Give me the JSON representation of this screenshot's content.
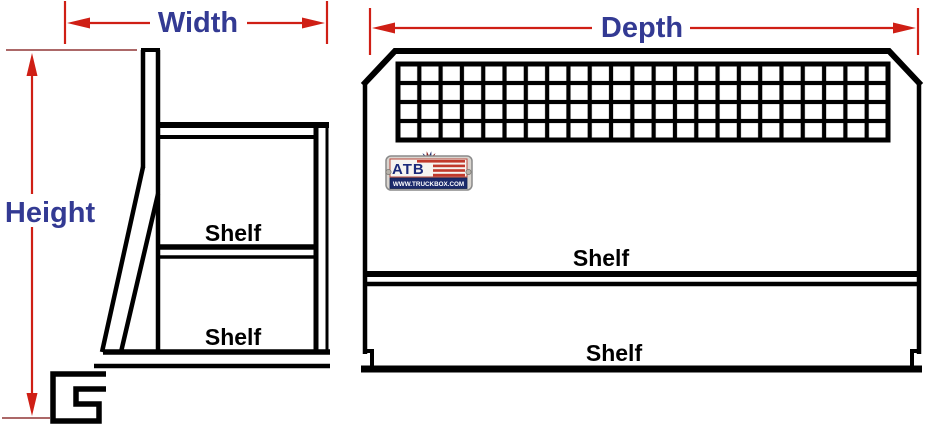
{
  "colors": {
    "dimension_line": "#cf1f15",
    "extension_line": "#a05252",
    "label_text": "#333a93",
    "structure_line": "#000000",
    "shelf_text": "#000000",
    "logo_band": "#1b2a6b",
    "logo_stripe": "#c0392b"
  },
  "dimensions": {
    "width": {
      "label": "Width"
    },
    "height": {
      "label": "Height"
    },
    "depth": {
      "label": "Depth"
    }
  },
  "side_view": {
    "shelves": [
      "Shelf",
      "Shelf"
    ]
  },
  "front_view": {
    "shelves": [
      "Shelf",
      "Shelf"
    ],
    "mesh_grid": {
      "rows": 4,
      "columns": 23
    }
  },
  "logo": {
    "brand": "ATB",
    "website": "WWW.TRUCKBOX.COM"
  }
}
